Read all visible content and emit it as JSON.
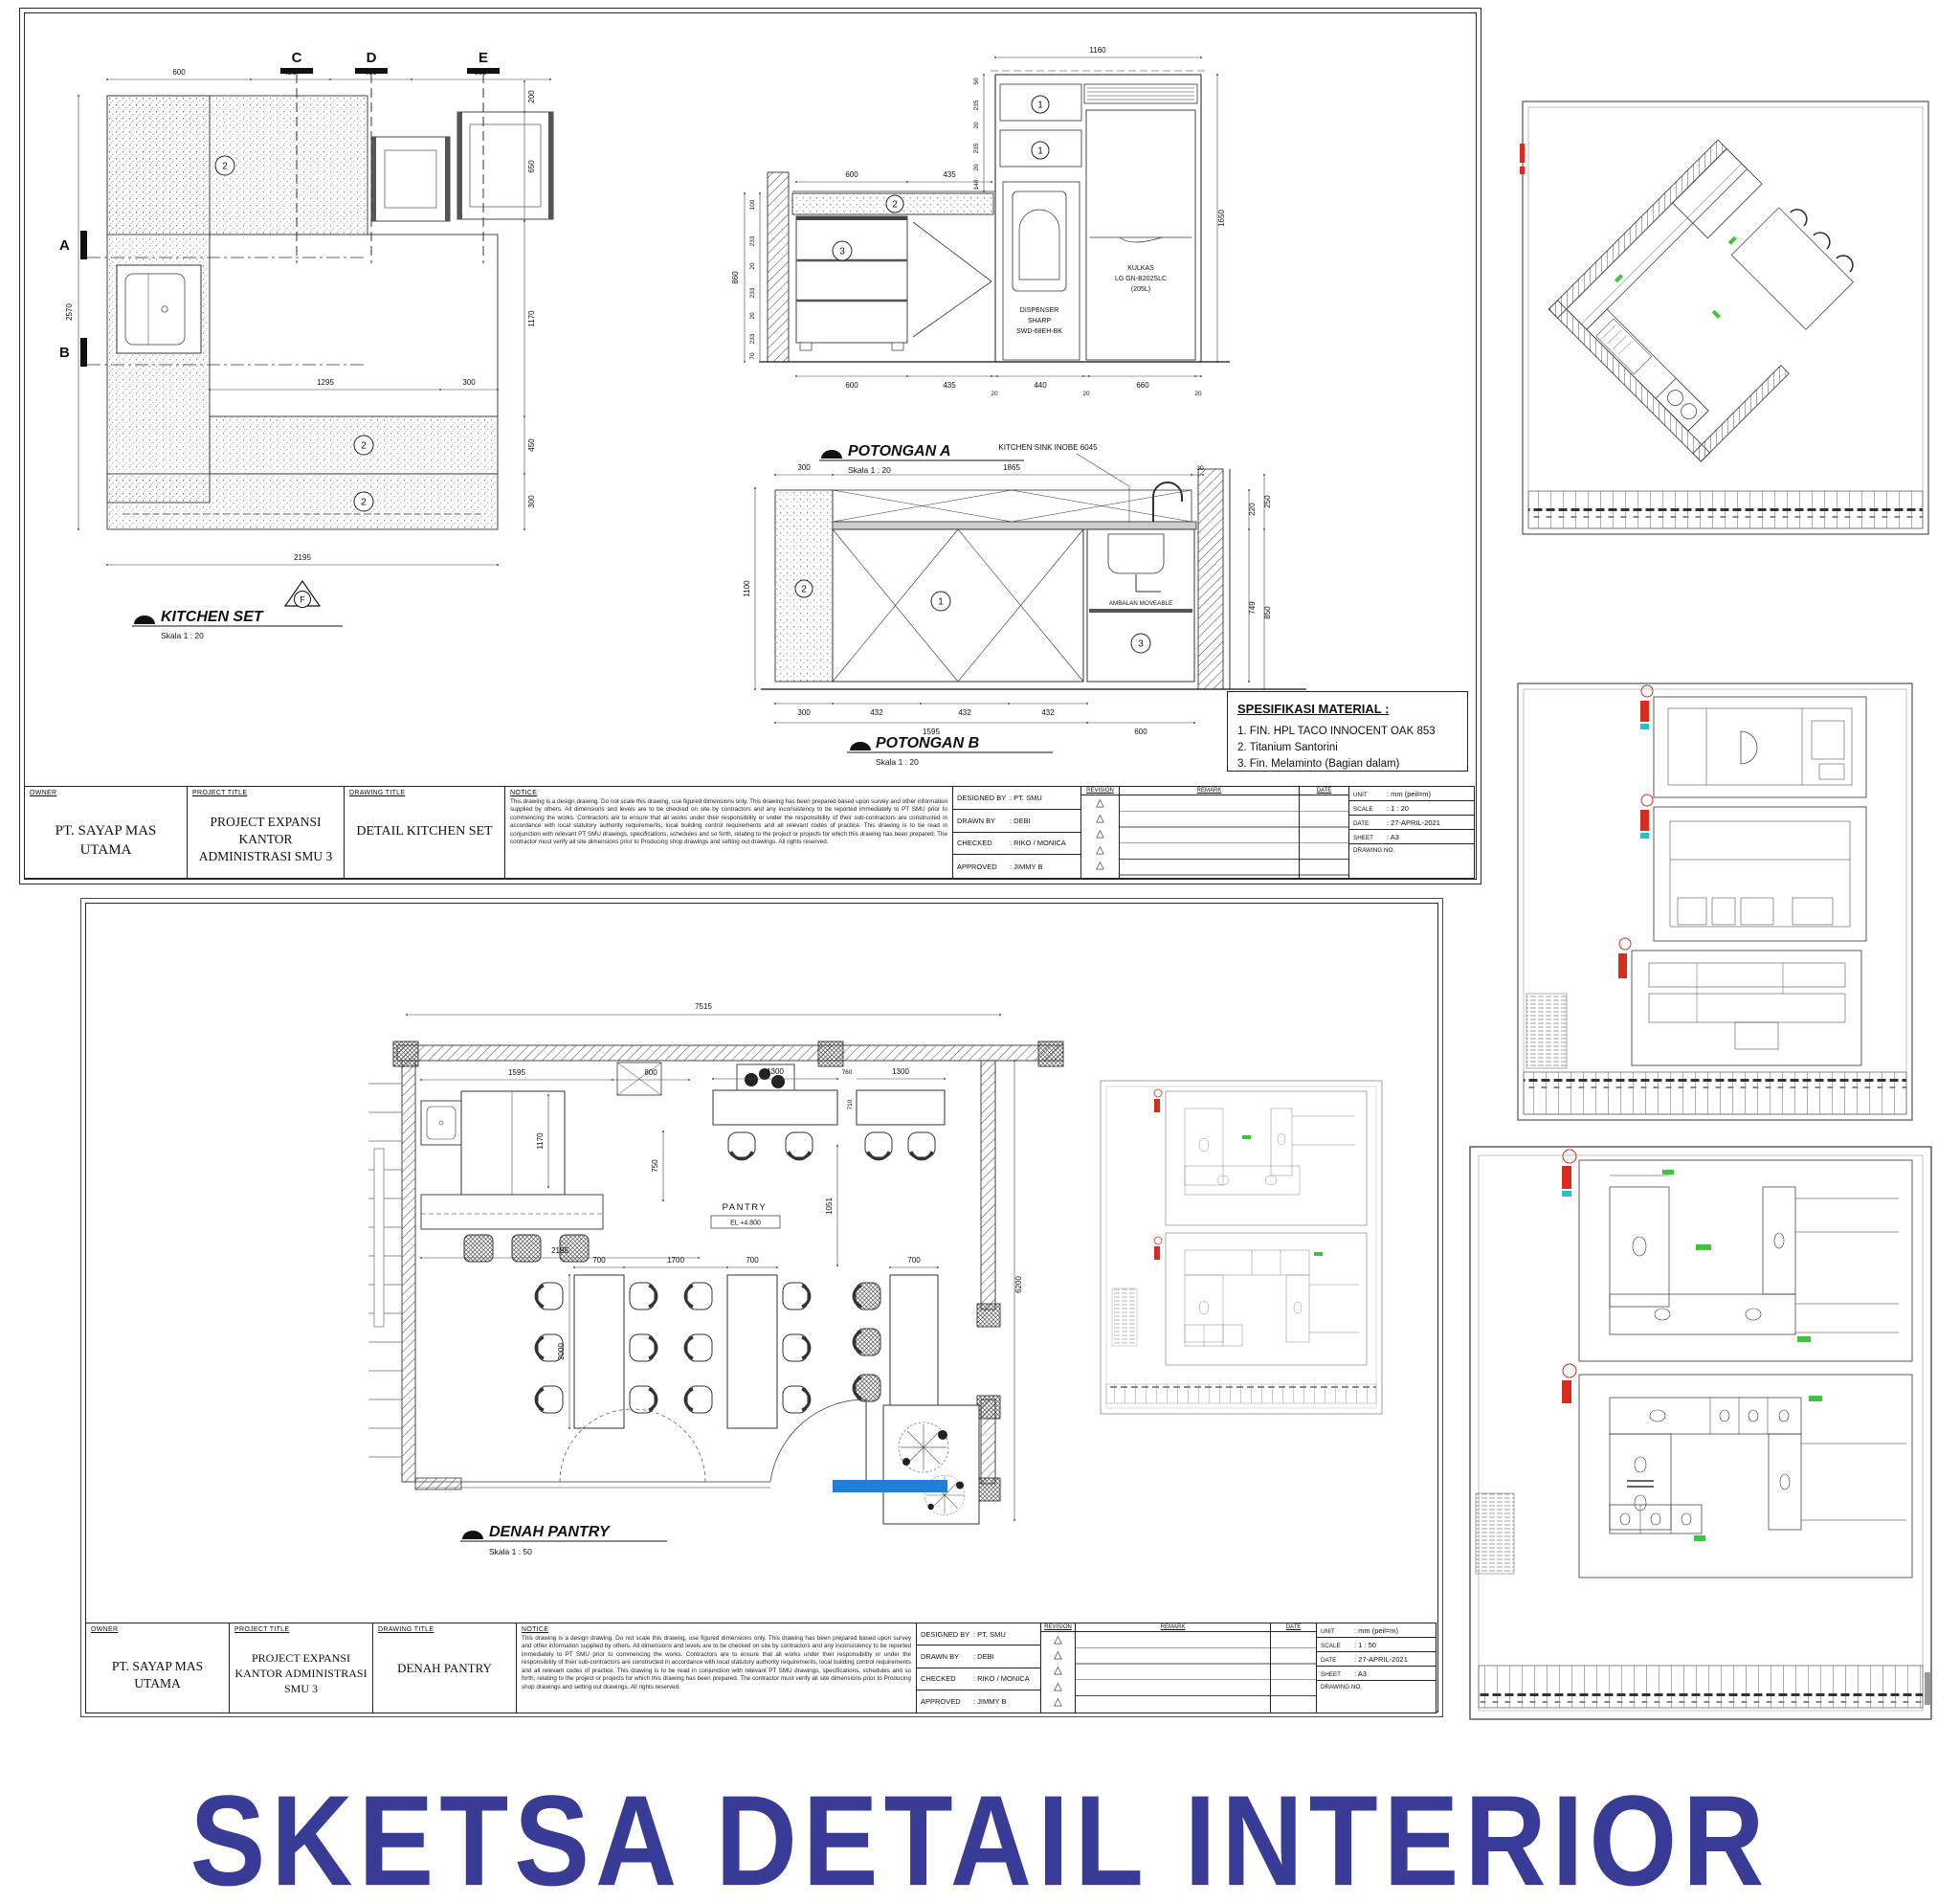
{
  "poster": {
    "title": "SKETSA DETAIL INTERIOR"
  },
  "colors": {
    "title_blue": "#383c96",
    "highlight_blue": "#1e80d8",
    "marker_red": "#d92b20",
    "annotation_green": "#3ec53e",
    "cyan_tick": "#2bbccc"
  },
  "tb": {
    "owner_label": "OWNER",
    "owner": "PT. SAYAP MAS UTAMA",
    "project_label": "PROJECT TITLE",
    "project1": "PROJECT EXPANSI",
    "project2": "KANTOR ADMINISTRASI SMU 3",
    "drawing_label": "DRAWING TITLE",
    "notice_label": "NOTICE",
    "notice": "This drawing is a design drawing. Do not scale this drawing, use figured dimensions only. This drawing has been prepared based upon survey and other information supplied by others. All dimensions and levels are to be checked on site by contractors and any inconsistency to be reported immediately to PT SMU prior to commencing the works. Contractors are to ensure that all works under their responsibility or under the responsibility of their sub-contractors are constructed in accordance with local statutory authority requirements, local building control requirements and all relevant codes of practice. This drawing is to be read in conjunction with relevant PT SMU drawings, specifications, schedules and so forth, relating to the project or projects for which this drawing has been prepared. The contractor must verify all site dimensions prior to Producing shop drawings and setting out drawings. All rights reserved.",
    "designed_label": "DESIGNED BY",
    "designed": ": PT. SMU",
    "drawn_label": "DRAWN BY",
    "drawn": ": DEBI",
    "checked_label": "CHECKED",
    "checked": ": RIKO / MONICA",
    "approved_label": "APPROVED",
    "approved": ": JIMMY B",
    "revision_label": "REVISION",
    "remark_label": "REMARK",
    "date_col_label": "DATE",
    "triangle": "△",
    "unit_label": "UNIT",
    "unit": ": mm (peil=m)",
    "scale_label": "SCALE",
    "date_label": "DATE",
    "date": ": 27-APRIL-2021",
    "sheet_label": "SHEET",
    "sheet": ": A3",
    "drawing_no_label": "DRAWING NO."
  },
  "sheet1": {
    "drawing_title": "DETAIL KITCHEN SET",
    "scale_value": ": 1 : 20",
    "kitchen_set": {
      "title": "KITCHEN SET",
      "scale": "Skala 1 : 20",
      "callout": "2",
      "markers": {
        "a": "A",
        "b": "B",
        "c": "C",
        "d": "D",
        "e": "E",
        "f": "F"
      },
      "dims": {
        "top": [
          "600",
          "435",
          "480",
          "680"
        ],
        "right": [
          "200",
          "650",
          "1170",
          "450",
          "300"
        ],
        "left": "2570",
        "bottom": "2195",
        "inner": [
          "1295",
          "300"
        ]
      }
    },
    "potongan_a": {
      "title": "POTONGAN A",
      "scale": "Skala 1 : 20",
      "callout1": "1",
      "callout2": "2",
      "callout3": "3",
      "dispenser": [
        "DISPENSER",
        "SHARP",
        "SWD-68EH-BK"
      ],
      "kulkas": [
        "KULKAS",
        "LG GN-B202SLC",
        "(205L)"
      ],
      "dims": {
        "top": "1160",
        "mid": [
          "600",
          "435"
        ],
        "bottom": [
          "600",
          "435",
          "20",
          "440",
          "20",
          "660",
          "20"
        ],
        "left_total": "860",
        "left_stack": [
          "100",
          "233",
          "20",
          "233",
          "20",
          "233",
          "70"
        ],
        "unit_stack": [
          "50",
          "235",
          "20",
          "235",
          "20",
          "140"
        ],
        "right": "1650"
      }
    },
    "potongan_b": {
      "title": "POTONGAN B",
      "scale": "Skala 1 : 20",
      "sink_callout": "KITCHEN SINK INOBE 6045",
      "ambalan": "AMBALAN MOVEABLE",
      "callout1": "1",
      "callout2": "2",
      "callout3": "3",
      "dims": {
        "top": [
          "300",
          "1865",
          "30"
        ],
        "left": "1100",
        "right": [
          "220",
          "250",
          "749",
          "850"
        ],
        "bottom": [
          "300",
          "432",
          "432",
          "432"
        ],
        "bottom2": [
          "1595",
          "600"
        ]
      }
    },
    "spesifikasi": {
      "title": "SPESIFIKASI MATERIAL :",
      "items": [
        "1. FIN. HPL TACO INNOCENT OAK 853",
        "2. Titanium Santorini",
        "3. Fin. Melaminto (Bagian dalam)"
      ]
    }
  },
  "sheet2": {
    "drawing_title": "DENAH PANTRY",
    "scale_value": ": 1 : 50",
    "denah": {
      "title": "DENAH PANTRY",
      "scale": "Skala 1 : 50",
      "room": "PANTRY",
      "room_elev": "EL +4.800",
      "dims": {
        "top": "7515",
        "counter": [
          "1595",
          "800"
        ],
        "bars": [
          "1300",
          "1300"
        ],
        "bar_gap": [
          "760",
          "710"
        ],
        "left_v": [
          "1170",
          "750"
        ],
        "island": "2195",
        "tables": [
          "700",
          "1700",
          "700"
        ],
        "extra": "700",
        "table_len": "2000",
        "chairs_v": "1051",
        "right_v": "6200"
      }
    }
  }
}
